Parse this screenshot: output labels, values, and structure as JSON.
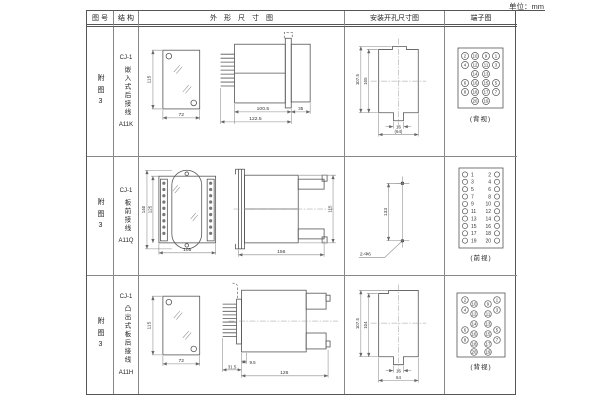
{
  "unit_label": "单位：mm",
  "table": {
    "headers": [
      "图号",
      "结构",
      "外形尺寸图",
      "安装开孔尺寸图",
      "端子图"
    ],
    "rows": [
      {
        "figure_no": "附图3",
        "structure": {
          "model": "CJ-1",
          "name": "嵌入式后接线",
          "code": "A11K"
        },
        "outline": {
          "height": "115",
          "width": "72",
          "body_len": "100.5",
          "total_len": "122.5",
          "rear_len": "35"
        },
        "install": {
          "outer": "107.5",
          "inner": "105",
          "slot": "16",
          "width": "(64)"
        },
        "terminal": {
          "caption": "(背视)",
          "outer_left": [
            "2",
            "4",
            "6",
            "8"
          ],
          "inner_left": [
            "10",
            "12",
            "14",
            "16",
            "18",
            "20"
          ],
          "inner_right": [
            "9",
            "11",
            "13",
            "15",
            "17",
            "19"
          ],
          "outer_right": [
            "1",
            "3",
            "5",
            "7"
          ]
        }
      },
      {
        "figure_no": "附图3",
        "structure": {
          "model": "CJ-1",
          "name": "板前接线",
          "code": "A11Q"
        },
        "outline": {
          "outer_height": "140",
          "inner_height": "125",
          "width": "105",
          "length": "156",
          "side_height": "115"
        },
        "install": {
          "span": "133",
          "holes": "2-Φ6"
        },
        "terminal": {
          "caption": "(前视)",
          "left": [
            "1",
            "3",
            "5",
            "7",
            "9",
            "11",
            "13",
            "15",
            "17",
            "19"
          ],
          "right": [
            "2",
            "4",
            "6",
            "8",
            "10",
            "12",
            "14",
            "16",
            "18",
            "20"
          ]
        }
      },
      {
        "figure_no": "附图3",
        "structure": {
          "model": "CJ-1",
          "name": "凸出式板后接线",
          "code": "A11H"
        },
        "outline": {
          "height": "115",
          "width": "72",
          "comb_len": "31.5",
          "stud_len": "9.5",
          "length": "126"
        },
        "install": {
          "outer": "107.5",
          "inner": "104",
          "slot": "16",
          "width": "64"
        },
        "terminal": {
          "caption": "(背视)",
          "outer_left": [
            "2",
            "4",
            "6",
            "8"
          ],
          "inner_left": [
            "10",
            "12",
            "14",
            "16",
            "18",
            "20"
          ],
          "inner_right": [
            "9",
            "11",
            "13",
            "15",
            "17",
            "19"
          ],
          "outer_right": [
            "1",
            "3",
            "5",
            "7"
          ]
        }
      }
    ]
  }
}
